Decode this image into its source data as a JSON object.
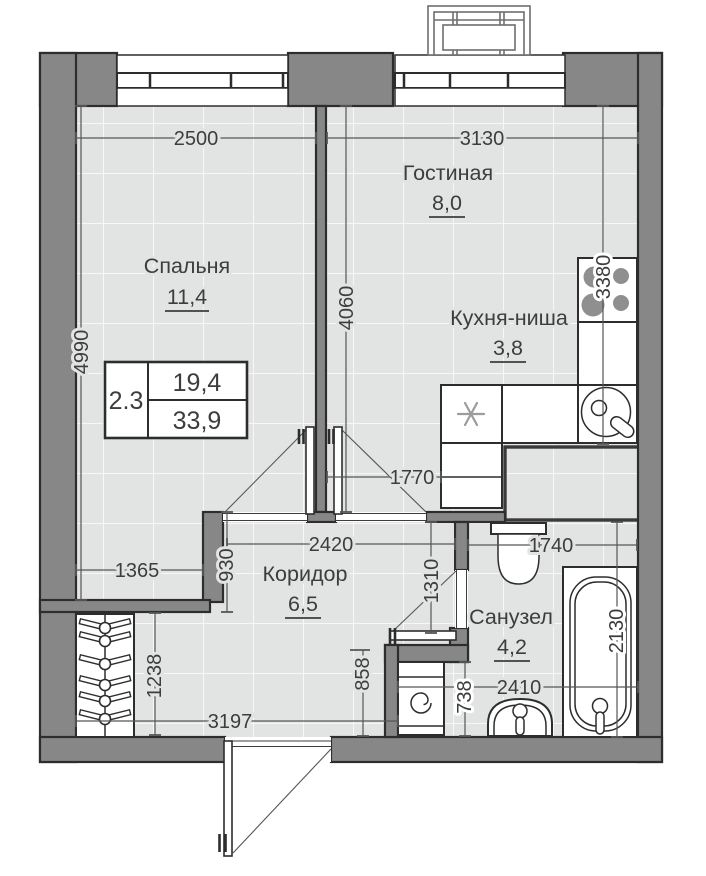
{
  "rooms": {
    "bedroom": {
      "label": "Спальня",
      "area": "11,4"
    },
    "living": {
      "label": "Гостиная",
      "area": "8,0"
    },
    "kitchen": {
      "label": "Кухня-ниша",
      "area": "3,8"
    },
    "corridor": {
      "label": "Коридор",
      "area": "6,5"
    },
    "bathroom": {
      "label": "Санузел",
      "area": "4,2"
    }
  },
  "stamp": {
    "left": "2.3",
    "top_right": "19,4",
    "bottom_right": "33,9"
  },
  "dims": {
    "d2500": "2500",
    "d3130": "3130",
    "d4990": "4990",
    "d4060": "4060",
    "d3380": "3380",
    "d1770": "1770",
    "d2420": "2420",
    "d930": "930",
    "d1365": "1365",
    "d1310": "1310",
    "d1740": "1740",
    "d2130": "2130",
    "d2410": "2410",
    "d738": "738",
    "d858": "858",
    "d3197": "3197",
    "d1238": "1238"
  },
  "colors": {
    "wall": "#878787",
    "wallline": "#2d2d2d",
    "floor": "#e2e4e3",
    "grid": "#f9faf9",
    "dim": "#565656",
    "text": "#3d3d3d",
    "burner": "#8f8f8f",
    "accent_star": "#9c9c9c"
  }
}
